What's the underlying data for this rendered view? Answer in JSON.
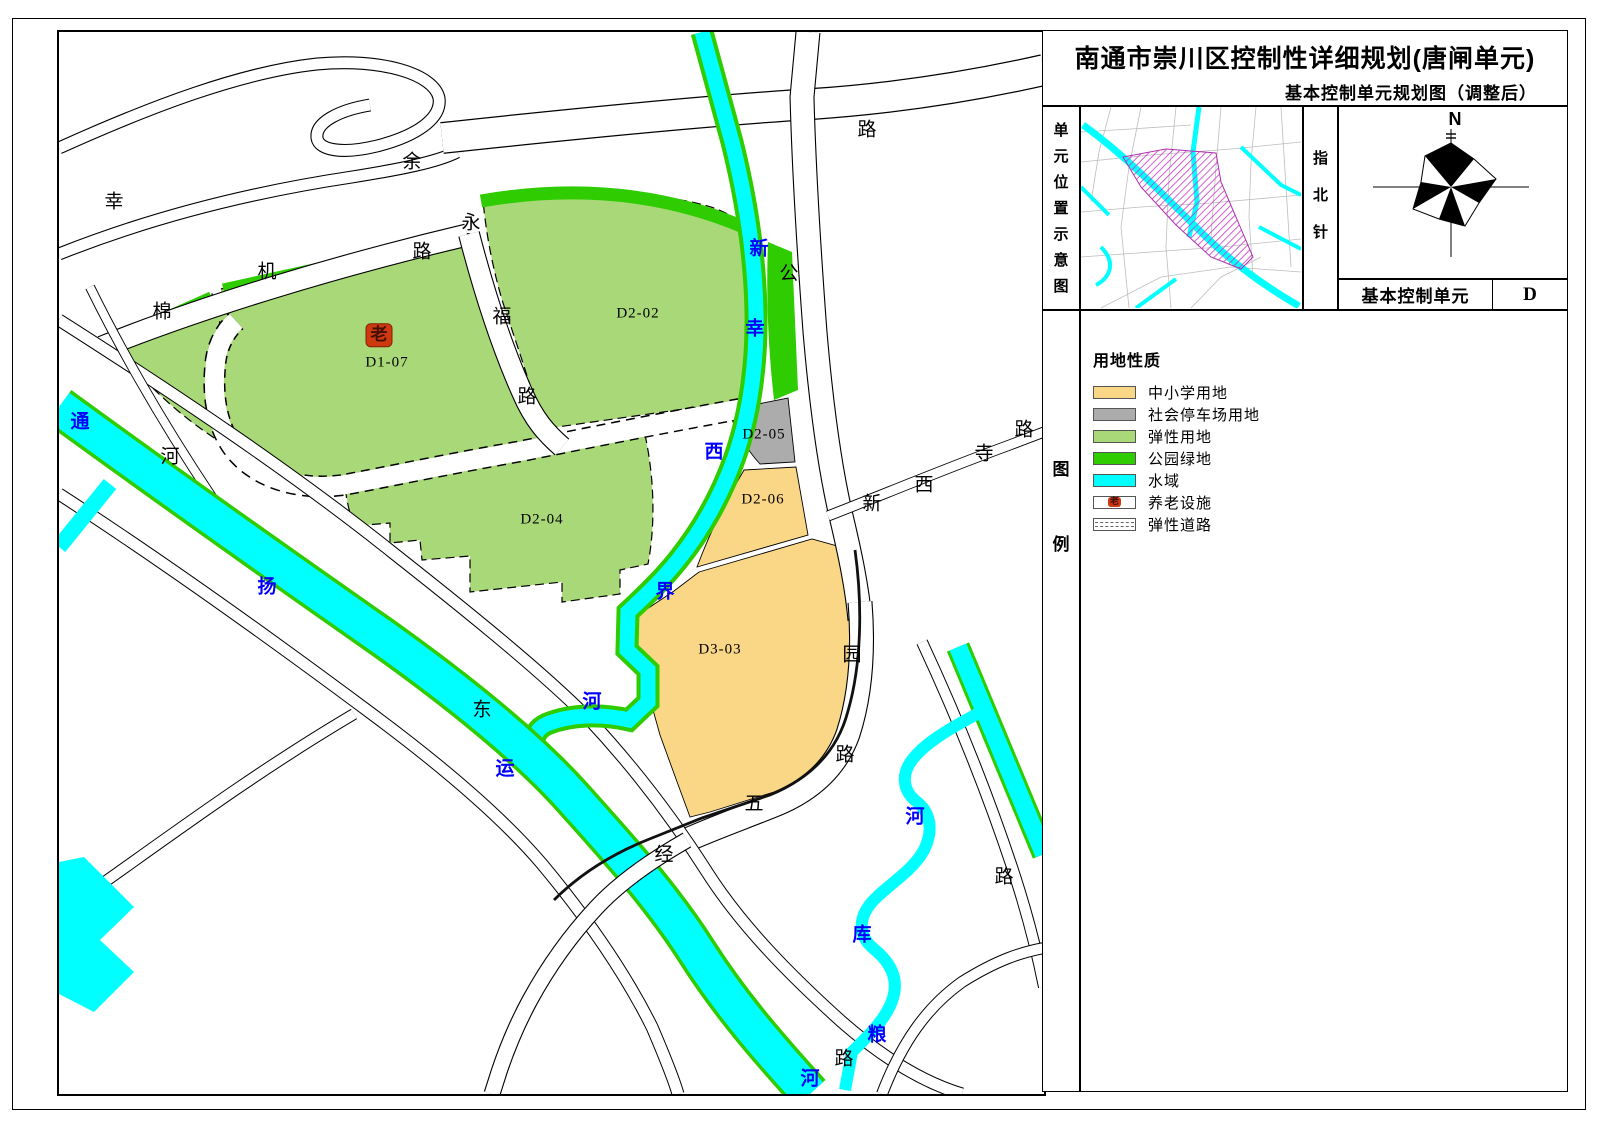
{
  "header": {
    "title": "南通市崇川区控制性详细规划(唐闸单元)",
    "subtitle": "基本控制单元规划图（调整后）"
  },
  "panel": {
    "location_label": "单元位置示意图",
    "compass_label": "指北针",
    "compass_n": "N",
    "unit_row": {
      "label": "基本控制单元",
      "value": "D"
    },
    "legend_label": "图例"
  },
  "legend": {
    "header": "用地性质",
    "items": [
      {
        "label": "中小学用地",
        "type": "fill",
        "color": "#FAD687"
      },
      {
        "label": "社会停车场用地",
        "type": "fill",
        "color": "#ACACAC"
      },
      {
        "label": "弹性用地",
        "type": "fill",
        "color": "#A9D878"
      },
      {
        "label": "公园绿地",
        "type": "fill",
        "color": "#2ECC00"
      },
      {
        "label": "水域",
        "type": "fill",
        "color": "#00FFFF"
      },
      {
        "label": "养老设施",
        "type": "marker",
        "marker": "老",
        "color": "#FFFFFF"
      },
      {
        "label": "弹性道路",
        "type": "dashed",
        "color": "#FFFFFF"
      }
    ]
  },
  "map": {
    "colors": {
      "flexible_land": "#A9D878",
      "park_green": "#2ECC00",
      "school_land": "#FAD687",
      "parking_land": "#ACACAC",
      "water": "#00FFFF",
      "elderly_red": "#CE3910",
      "river_text": "#0000FF"
    },
    "parcels": [
      {
        "id": "D1-07",
        "x": 328,
        "y": 331
      },
      {
        "id": "D2-02",
        "x": 579,
        "y": 282
      },
      {
        "id": "D2-04",
        "x": 483,
        "y": 488
      },
      {
        "id": "D2-05",
        "x": 705,
        "y": 403
      },
      {
        "id": "D2-06",
        "x": 704,
        "y": 468
      },
      {
        "id": "D3-03",
        "x": 661,
        "y": 618
      }
    ],
    "elderly_marker": {
      "text": "老",
      "x": 320,
      "y": 303
    },
    "road_labels": [
      {
        "text": "幸",
        "x": 55,
        "y": 170
      },
      {
        "text": "余",
        "x": 353,
        "y": 130
      },
      {
        "text": "路",
        "x": 808,
        "y": 98
      },
      {
        "text": "公",
        "x": 730,
        "y": 242
      },
      {
        "text": "棉",
        "x": 103,
        "y": 280
      },
      {
        "text": "机",
        "x": 208,
        "y": 240
      },
      {
        "text": "路",
        "x": 363,
        "y": 220
      },
      {
        "text": "永",
        "x": 412,
        "y": 191
      },
      {
        "text": "福",
        "x": 443,
        "y": 285
      },
      {
        "text": "路",
        "x": 468,
        "y": 365
      },
      {
        "text": "河",
        "x": 111,
        "y": 425
      },
      {
        "text": "东",
        "x": 423,
        "y": 678
      },
      {
        "text": "新",
        "x": 813,
        "y": 472
      },
      {
        "text": "西",
        "x": 865,
        "y": 453
      },
      {
        "text": "寺",
        "x": 925,
        "y": 422
      },
      {
        "text": "路",
        "x": 965,
        "y": 398
      },
      {
        "text": "园",
        "x": 793,
        "y": 623
      },
      {
        "text": "路",
        "x": 786,
        "y": 723
      },
      {
        "text": "五",
        "x": 695,
        "y": 772
      },
      {
        "text": "经",
        "x": 605,
        "y": 823
      },
      {
        "text": "路",
        "x": 945,
        "y": 845
      },
      {
        "text": "路",
        "x": 785,
        "y": 1027
      }
    ],
    "river_labels": [
      {
        "text": "通",
        "x": 21,
        "y": 390
      },
      {
        "text": "扬",
        "x": 208,
        "y": 555
      },
      {
        "text": "运",
        "x": 446,
        "y": 737
      },
      {
        "text": "河",
        "x": 751,
        "y": 1047
      },
      {
        "text": "新",
        "x": 700,
        "y": 217
      },
      {
        "text": "幸",
        "x": 696,
        "y": 297
      },
      {
        "text": "西",
        "x": 655,
        "y": 420
      },
      {
        "text": "界",
        "x": 606,
        "y": 560
      },
      {
        "text": "河",
        "x": 533,
        "y": 670
      },
      {
        "text": "河",
        "x": 856,
        "y": 785
      },
      {
        "text": "库",
        "x": 803,
        "y": 903
      },
      {
        "text": "粮",
        "x": 818,
        "y": 1003
      }
    ]
  }
}
